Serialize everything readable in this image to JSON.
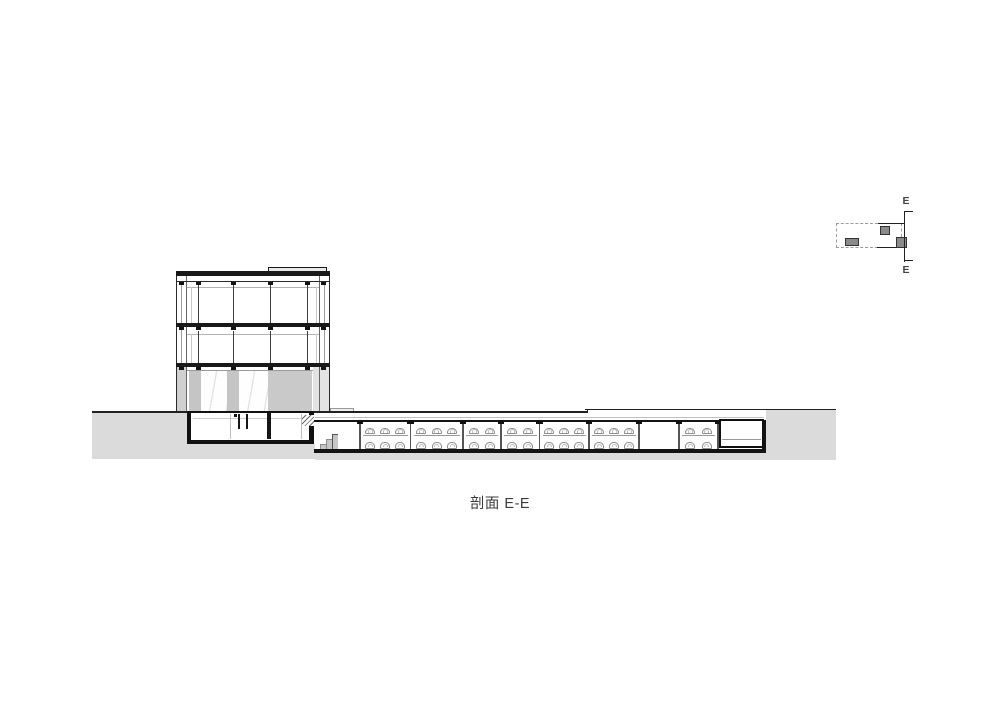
{
  "title": {
    "caption": "剖面 E-E"
  },
  "keyplan": {
    "label_top": "E",
    "label_bottom": "E"
  },
  "colors": {
    "line_dark": "#191919",
    "soil_gray": "#dbdbdb",
    "core_gray": "#c9c9c9",
    "keyplan_fill": "#8a8a8a",
    "car_outline": "#8e8e8e"
  },
  "garage": {
    "ceiling_y": 420,
    "floor_y": 449,
    "car_width": 10,
    "top_row_y": 427.8,
    "bottom_row_y": 442.3,
    "platform_y": 434.5,
    "columns_x": [
      360,
      410.5,
      463,
      501,
      539.5,
      589,
      639,
      679,
      718
    ],
    "bays": [
      {
        "x1": 315,
        "x2": 360,
        "top": 0,
        "bottom": 0
      },
      {
        "x1": 360,
        "x2": 410.5,
        "top": 3,
        "bottom": 3
      },
      {
        "x1": 410.5,
        "x2": 463,
        "top": 3,
        "bottom": 3
      },
      {
        "x1": 463,
        "x2": 501,
        "top": 2,
        "bottom": 2
      },
      {
        "x1": 501,
        "x2": 539.5,
        "top": 2,
        "bottom": 2
      },
      {
        "x1": 539.5,
        "x2": 589,
        "top": 3,
        "bottom": 3
      },
      {
        "x1": 589,
        "x2": 639,
        "top": 3,
        "bottom": 3
      },
      {
        "x1": 639,
        "x2": 679,
        "top": 0,
        "bottom": 0
      },
      {
        "x1": 679,
        "x2": 718,
        "top": 2,
        "bottom": 2
      }
    ]
  }
}
